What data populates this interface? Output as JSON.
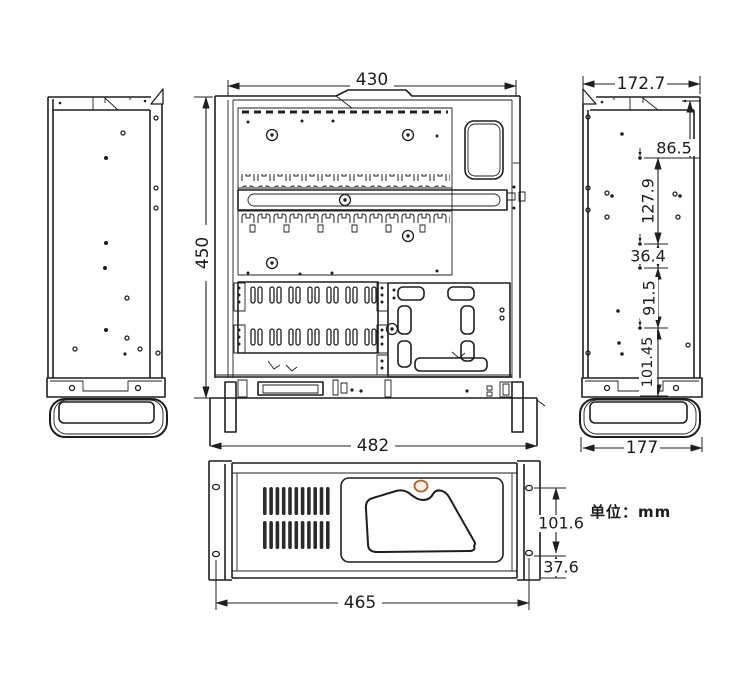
{
  "unit_note": "单位：mm",
  "dimensions": {
    "top_view_width": "430",
    "chassis_depth": "450",
    "side_top_width": "172.7",
    "rear_hole_offset": "86.5",
    "hole_pitch_1": "127.9",
    "hole_pitch_2": "36.4",
    "hole_pitch_3": "91.5",
    "hole_pitch_4": "101.45",
    "side_bottom_width": "177",
    "overall_flange_width": "482",
    "front_panel_width": "465",
    "ear_hole_spacing": "101.6",
    "ear_hole_bottom_offset": "37.6"
  },
  "colors": {
    "line": "#1f1f1f",
    "lock_ring_stroke": "#b2602f",
    "lock_ring_fill": "#fbeee2",
    "unit_note_text": "#3f3428"
  }
}
